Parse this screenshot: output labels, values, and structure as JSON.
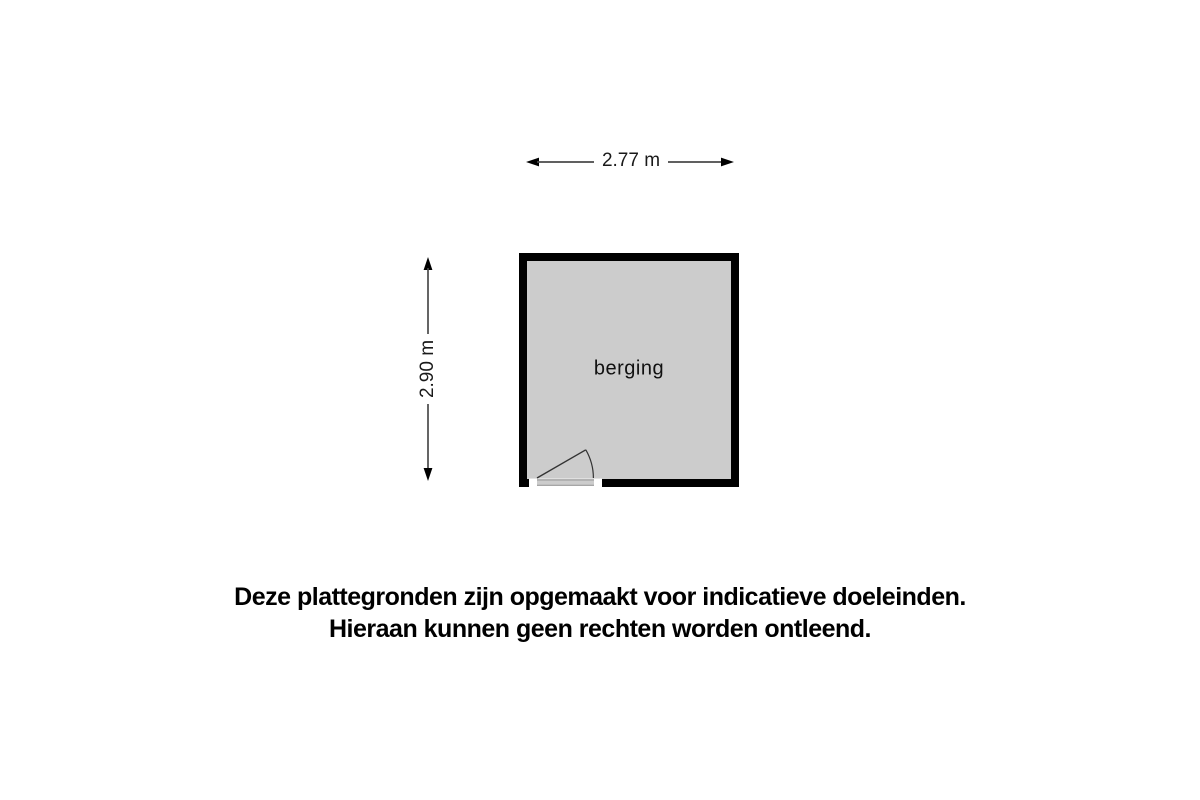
{
  "page": {
    "background": "#ffffff"
  },
  "floor_plan": {
    "room": {
      "label": "berging",
      "fill": "#cccccc",
      "wall_color": "#000000"
    },
    "door": {
      "stroke": "#333333",
      "jamb_fill": "#ffffff",
      "threshold_color": "#999999"
    },
    "dimensions": {
      "width": {
        "label": "2.77 m"
      },
      "height": {
        "label": "2.90 m"
      },
      "line_color": "#4a4a4a",
      "arrow_color": "#000000"
    }
  },
  "disclaimer": {
    "line1": "Deze plattegronden zijn opgemaakt voor indicatieve doeleinden.",
    "line2": "Hieraan kunnen geen rechten worden ontleend."
  }
}
